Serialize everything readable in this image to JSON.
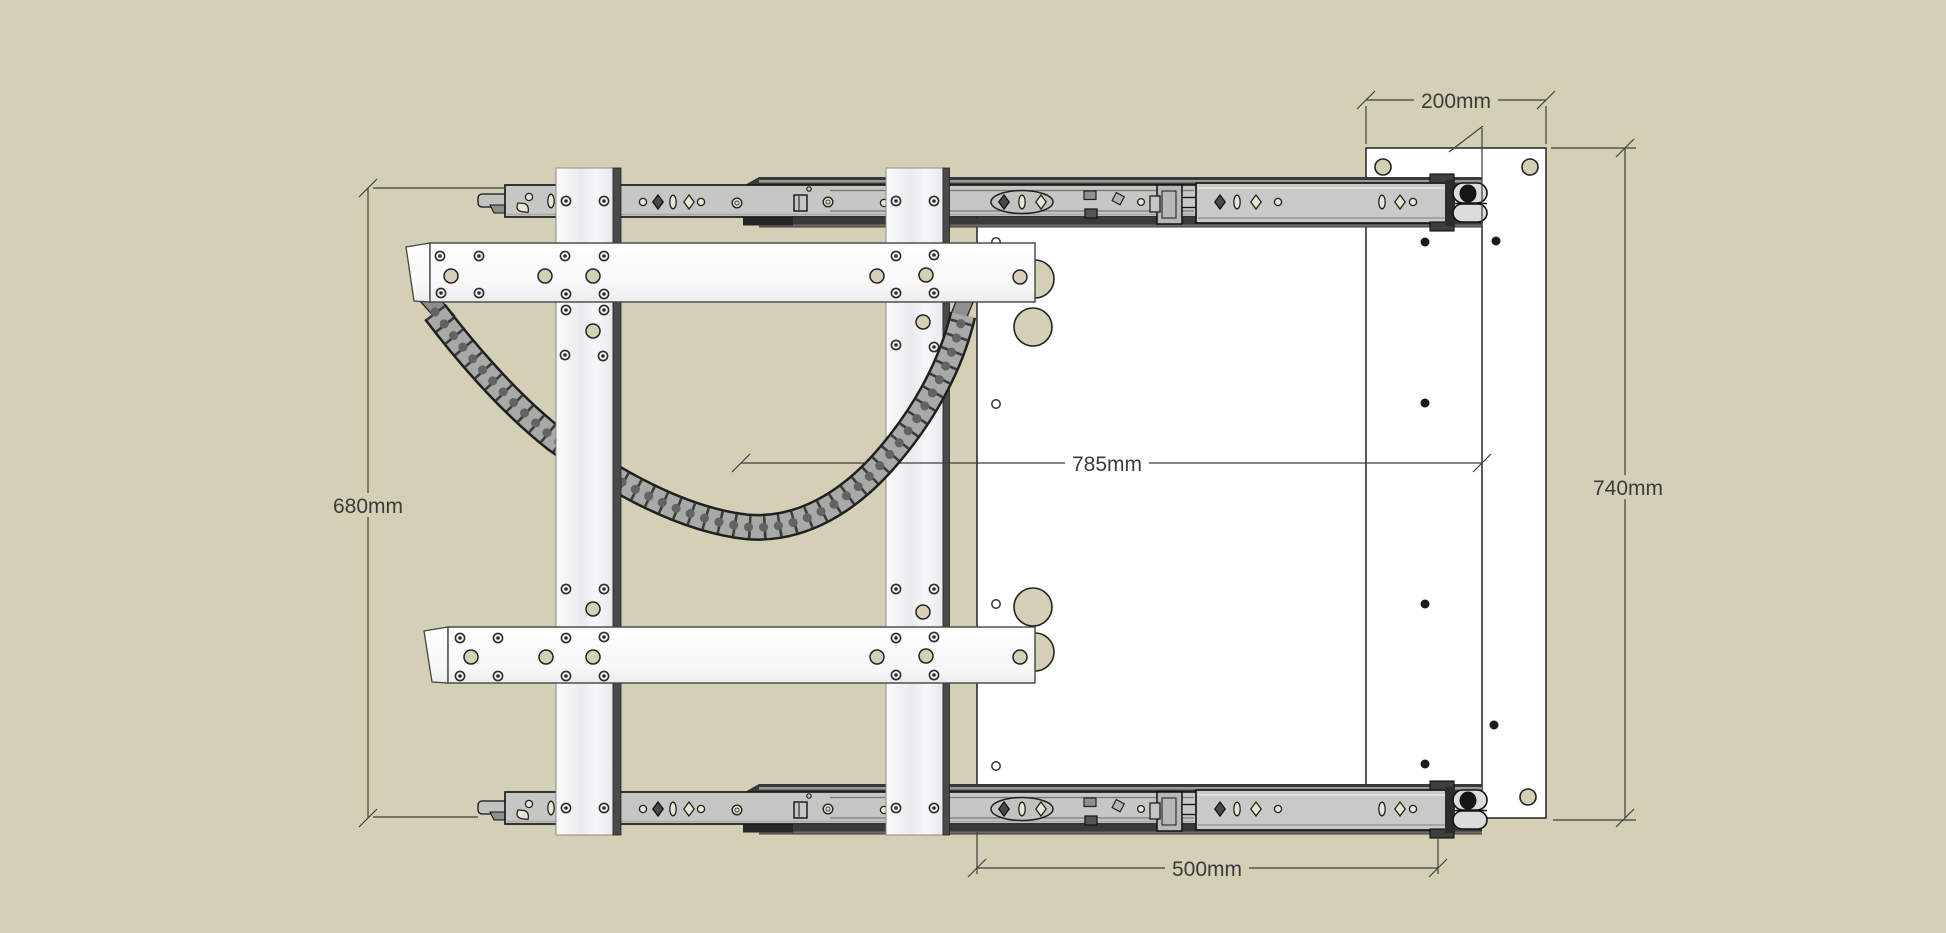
{
  "drawing": {
    "type": "cad-top-view-drawer-slide-assembly",
    "background_color": "#d3d0b6",
    "line_color": "#3f3f3f",
    "dimensions": {
      "top_width": {
        "label": "200mm"
      },
      "right_height": {
        "label": "740mm"
      },
      "middle_width": {
        "label": "785mm"
      },
      "left_height": {
        "label": "680mm"
      },
      "bottom_width": {
        "label": "500mm"
      }
    },
    "parts": {
      "top_slide": "telescopic-drawer-slide",
      "bottom_slide": "telescopic-drawer-slide",
      "drawer_panel": "large-white-panel",
      "side_panel": "right-mounting-panel",
      "bracket_left": "vertical-bracket",
      "bracket_right": "vertical-bracket",
      "crossbar_top": "horizontal-mounting-bar",
      "crossbar_bottom": "horizontal-mounting-bar",
      "cable_chain": "drag-chain"
    }
  }
}
